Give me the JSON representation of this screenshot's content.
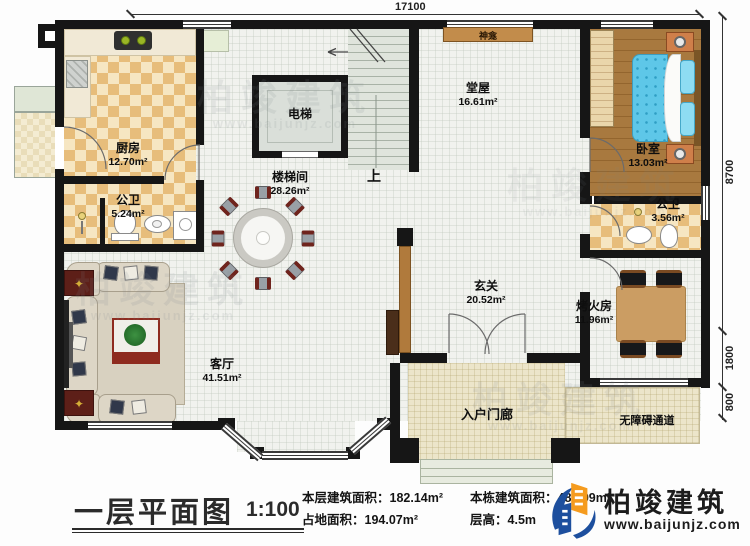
{
  "watermark": {
    "brand": "柏竣建筑",
    "url": "www.baijunjz.com"
  },
  "dimensions": {
    "top": "17100",
    "right_upper": "8700",
    "right_middle": "1800",
    "right_lower": "800"
  },
  "plan_labels": {
    "up": "上",
    "shrine": "神龛",
    "entry_porch": "入户门廊",
    "accessible_ramp": "无障碍通道"
  },
  "rooms": {
    "kitchen": {
      "name": "厨房",
      "area": "12.70m²"
    },
    "bath1": {
      "name": "公卫",
      "area": "5.24m²"
    },
    "elevator": {
      "name": "电梯"
    },
    "stairwell": {
      "name": "楼梯间",
      "area": "28.26m²"
    },
    "hall": {
      "name": "堂屋",
      "area": "16.61m²"
    },
    "bedroom": {
      "name": "卧室",
      "area": "13.03m²"
    },
    "bath2": {
      "name": "公卫",
      "area": "3.56m²"
    },
    "foyer": {
      "name": "玄关",
      "area": "20.52m²"
    },
    "fire_room": {
      "name": "烤火房",
      "area": "11.96m²"
    },
    "living_room": {
      "name": "客厅",
      "area": "41.51m²"
    }
  },
  "footer": {
    "title": "一层平面图",
    "scale": "1:100",
    "stats": [
      {
        "label": "本层建筑面积：",
        "value": "182.14m²"
      },
      {
        "label": "占地面积：",
        "value": "194.07m²"
      },
      {
        "label": "本栋建筑面积：",
        "value": "489.99m²"
      },
      {
        "label": "层高：",
        "value": "4.5m"
      }
    ],
    "brand": "柏竣建筑",
    "brand_url": "www.baijunjz.com"
  }
}
